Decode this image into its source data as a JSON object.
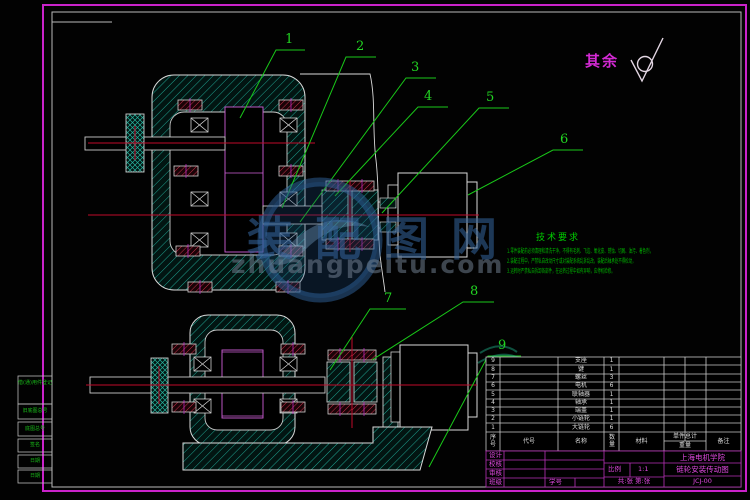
{
  "sheet": {
    "surface_note": "其余",
    "left_tabs": [
      "借(通)用件登记",
      "旧底图总号",
      "底图总号",
      "签名",
      "日期",
      "日期"
    ],
    "colors": {
      "frame_magenta": "#d42ad4",
      "line_white": "#d9d9d9",
      "hatch_teal": "#1fa391",
      "centerline_red": "#c00a2a",
      "annotation_green": "#1ecb1e"
    }
  },
  "watermark": {
    "logo": "circle-swoosh-logo",
    "cn_text": "装配图网",
    "url_text": "zhuangpeitu.com"
  },
  "balloons": [
    "1",
    "2",
    "3",
    "4",
    "5",
    "6",
    "7",
    "8",
    "9"
  ],
  "tech": {
    "title": "技术要求",
    "lines": [
      "1.零件装配前必须清理和清洗干净，不得有毛刺、飞边、氧化皮、锈蚀、切屑、油污、着色剂，",
      "2.装配过程中，严禁私自改动尺寸或对装配系统乱拆乱改，装配后轴承处不得松动，",
      "3.运转时严禁私自拆卸各部件，在运转过程中如有异响，应停机检修。"
    ]
  },
  "bom": {
    "headers": {
      "seq": "序号",
      "code": "代号",
      "name": "名称",
      "qty": "数量",
      "material": "材料",
      "weight_top": "单件总计",
      "weight_bottom": "重量",
      "note": "备注"
    },
    "rows": [
      {
        "seq": "9",
        "name": "支座",
        "qty": "1"
      },
      {
        "seq": "8",
        "name": "键",
        "qty": "1"
      },
      {
        "seq": "7",
        "name": "螺丝",
        "qty": "3"
      },
      {
        "seq": "6",
        "name": "电机",
        "qty": "6"
      },
      {
        "seq": "5",
        "name": "联轴器",
        "qty": "1"
      },
      {
        "seq": "4",
        "name": "轴承",
        "qty": "1"
      },
      {
        "seq": "3",
        "name": "端盖",
        "qty": "1"
      },
      {
        "seq": "2",
        "name": "小链轮",
        "qty": "1"
      },
      {
        "seq": "1",
        "name": "大链轮",
        "qty": "6"
      }
    ]
  },
  "titleblock": {
    "design_label": "设计",
    "check_label": "校核",
    "audit_label": "审核",
    "class_label": "班级",
    "student_label": "学号",
    "scale_label": "比例",
    "scale_value": "1:1",
    "sheet_note": "共:张  第:张",
    "school": "上海电机学院",
    "drawing_title": "链轮安装传动图",
    "drawing_no": "JCJ-00"
  }
}
